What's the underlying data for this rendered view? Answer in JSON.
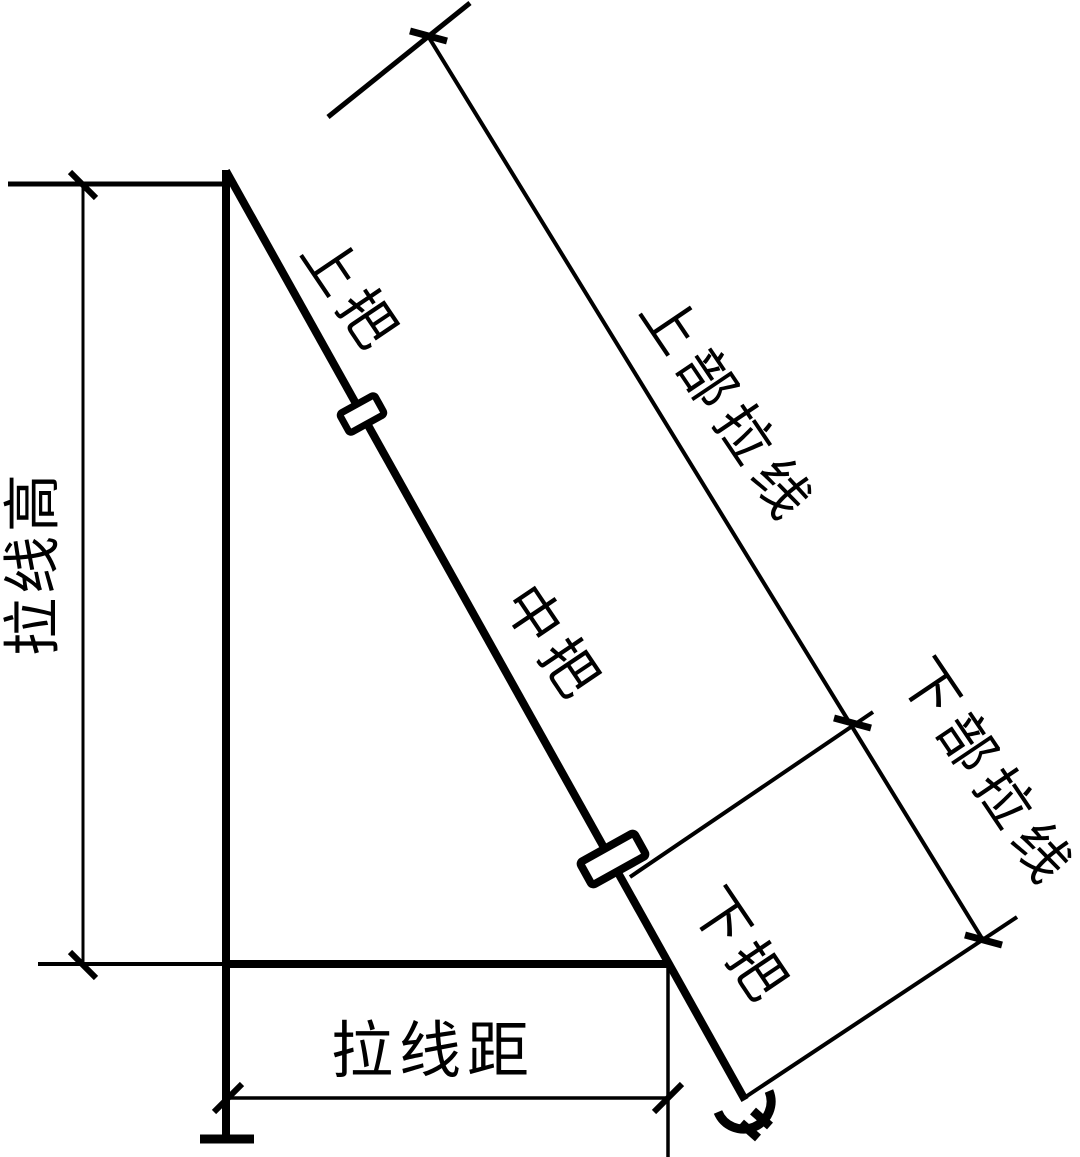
{
  "figure": {
    "background_color": "#ffffff",
    "line_color": "#000000"
  },
  "labels": {
    "guy_wire_height": "拉线高",
    "guy_wire_distance": "拉线距",
    "upper_grip": "上把",
    "middle_grip": "中把",
    "lower_grip": "下把",
    "upper_guy_wire": "上部拉线",
    "lower_guy_wire": "下部拉线"
  }
}
